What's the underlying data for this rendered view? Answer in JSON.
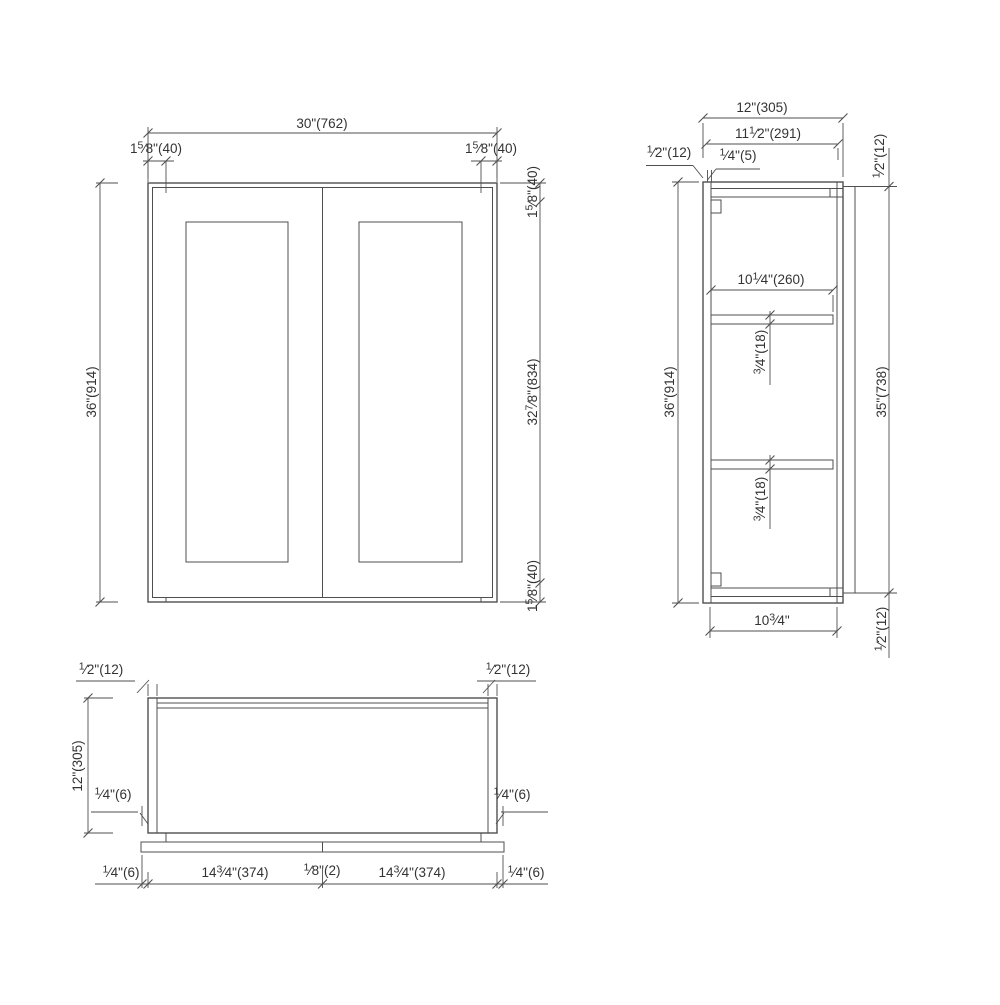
{
  "drawing": {
    "type": "cabinet-3-view-technical-drawing",
    "background": "#ffffff",
    "line_color": "#4f4f4f",
    "text_color": "#333333",
    "views": {
      "front": {
        "label": "front elevation",
        "dims": {
          "width": {
            "pre": "30",
            "post": "\"(762)"
          },
          "stile_left": {
            "pre": "1",
            "num": "5",
            "den": "8",
            "post": "\"(40)"
          },
          "stile_right": {
            "pre": "1",
            "num": "5",
            "den": "8",
            "post": "\"(40)"
          },
          "height": {
            "pre": "36",
            "post": "\"(914)"
          },
          "rail_top": {
            "pre": "1",
            "num": "5",
            "den": "8",
            "post": "\"(40)"
          },
          "opening": {
            "pre": "32",
            "num": "7",
            "den": "8",
            "post": "\"(834)"
          },
          "rail_bottom": {
            "pre": "1",
            "num": "5",
            "den": "8",
            "post": "\"(40)"
          }
        }
      },
      "side": {
        "label": "side section",
        "dims": {
          "depth": {
            "pre": "12",
            "post": "\"(305)"
          },
          "depth_interior": {
            "pre": "11",
            "num": "1",
            "den": "2",
            "post": "\"(291)"
          },
          "door_thickness": {
            "num": "1",
            "den": "2",
            "post": "\"(12)"
          },
          "top_reveal": {
            "num": "1",
            "den": "4",
            "post": "\"(5)"
          },
          "top_rail": {
            "num": "1",
            "den": "2",
            "post": "\"(12)"
          },
          "height": {
            "pre": "36",
            "post": "\"(914)"
          },
          "shelf_depth": {
            "pre": "10",
            "num": "1",
            "den": "4",
            "post": "\"(260)"
          },
          "shelf_top_thickness": {
            "num": "3",
            "den": "4",
            "post": "\"(18)"
          },
          "shelf_bottom_thickness": {
            "num": "3",
            "den": "4",
            "post": "\"(18)"
          },
          "back_height": {
            "pre": "35",
            "post": "\"(738)"
          },
          "bottom_depth": {
            "pre": "10",
            "num": "3",
            "den": "4",
            "post": "\""
          },
          "bottom_rail": {
            "num": "1",
            "den": "2",
            "post": "\"(12)"
          }
        }
      },
      "plan": {
        "label": "bottom plan",
        "dims": {
          "side_thickness_left": {
            "num": "1",
            "den": "2",
            "post": "\"(12)"
          },
          "side_thickness_right": {
            "num": "1",
            "den": "2",
            "post": "\"(12)"
          },
          "depth": {
            "pre": "12",
            "post": "\"(305)"
          },
          "door_gap_left": {
            "num": "1",
            "den": "4",
            "post": "\"(6)"
          },
          "door_gap_right": {
            "num": "1",
            "den": "4",
            "post": "\"(6)"
          },
          "overhang_left": {
            "num": "1",
            "den": "4",
            "post": "\"(6)"
          },
          "door_left_width": {
            "pre": "14",
            "num": "3",
            "den": "4",
            "post": "\"(374)"
          },
          "center_gap": {
            "num": "1",
            "den": "8",
            "post": "\"(2)"
          },
          "door_right_width": {
            "pre": "14",
            "num": "3",
            "den": "4",
            "post": "\"(374)"
          },
          "overhang_right": {
            "num": "1",
            "den": "4",
            "post": "\"(6)"
          }
        }
      }
    }
  }
}
